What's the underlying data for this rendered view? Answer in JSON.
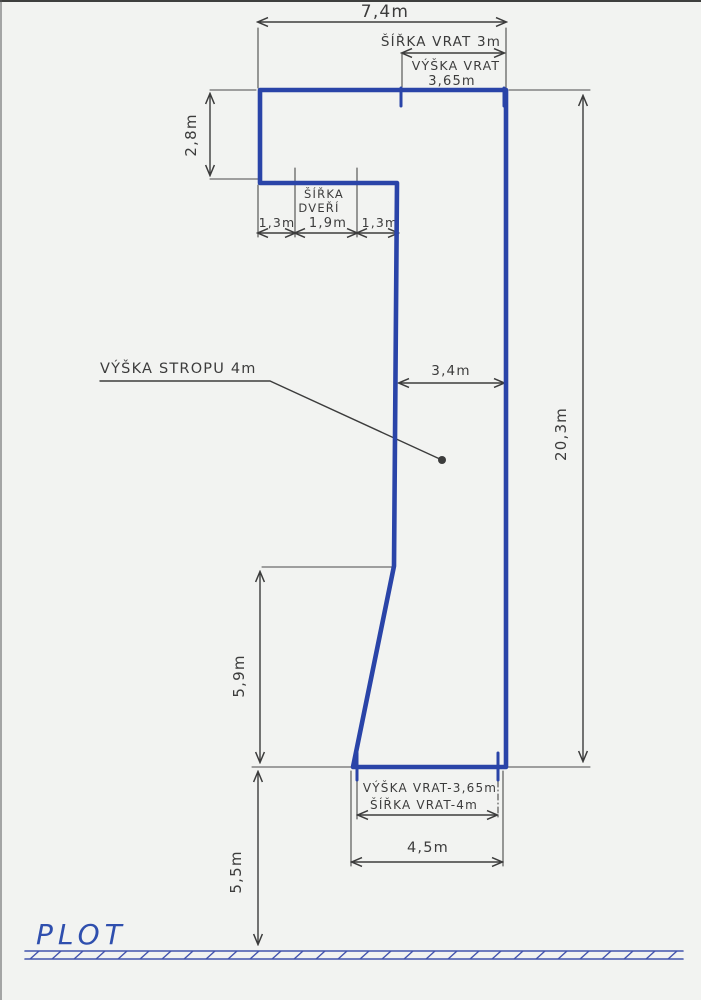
{
  "diagram": {
    "colors": {
      "wall": "#2a44a8",
      "fence": "#4354ae",
      "plot_label": "#2f4fae",
      "pencil": "#3c3c3c",
      "paper": "#f2f3f1"
    },
    "dimensions": {
      "top_width": "7,4m",
      "upper_left_height": "2,8m",
      "door_left_offset": "1,3m",
      "door_width": "1,9m",
      "door_right_offset": "1,3m",
      "mid_width": "3,4m",
      "right_height": "20,3m",
      "lower_left_height": "5,9m",
      "fence_distance": "5,5m",
      "bottom_width": "4,5m"
    },
    "labels": {
      "top_gate_width": "ŠÍŘKA VRAT 3m",
      "top_gate_height_line1": "VÝŠKA VRAT",
      "top_gate_height_line2": "3,65m",
      "door_line1": "ŠÍŘKA",
      "door_line2": "DVEŘÍ",
      "ceiling_height": "VÝŠKA STROPU 4m",
      "bottom_gate_height": "VÝŠKA VRAT-3,65m",
      "bottom_gate_width": "ŠÍŘKA VRAT-4m",
      "bottom_width_label": "4,5m",
      "fence": "PLOT"
    }
  }
}
